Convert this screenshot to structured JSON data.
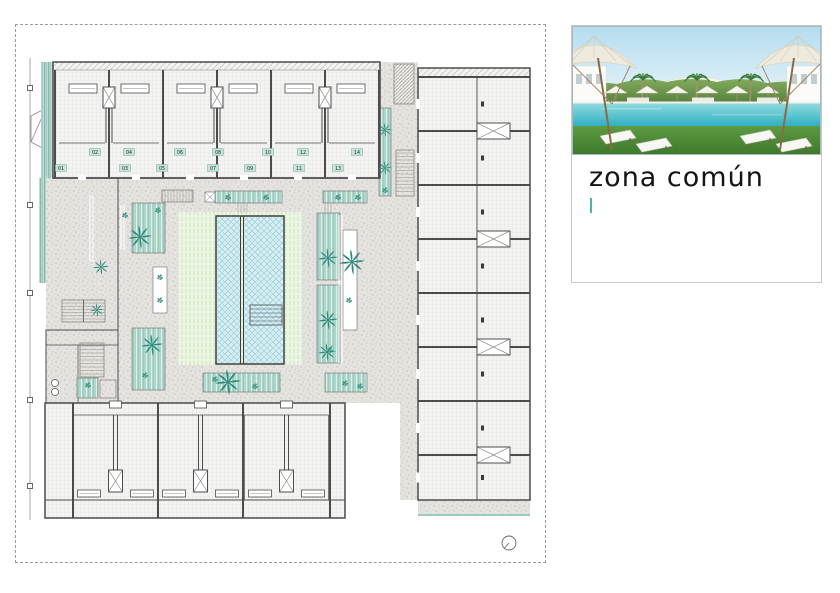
{
  "plan": {
    "units_upper": [
      "02",
      "04",
      "06",
      "08",
      "10",
      "12",
      "14"
    ],
    "units_lower": [
      "01",
      "03",
      "05",
      "07",
      "09",
      "11",
      "13"
    ]
  },
  "card": {
    "title": "zona común",
    "cursor_color": "#45b8ac"
  },
  "palette": {
    "wall_gray": "#4c4c4c",
    "path_gray": "#e5e3df",
    "planter_teal": "#aed6ca",
    "tree_teal": "#2e8a7c",
    "pool_blue": "#d8eef3",
    "lawn_green": "#edf6e4",
    "chip_bg": "#c7e4da",
    "pool_render_water": "#2fb0c2",
    "grass_green": "#3c7a2c"
  }
}
